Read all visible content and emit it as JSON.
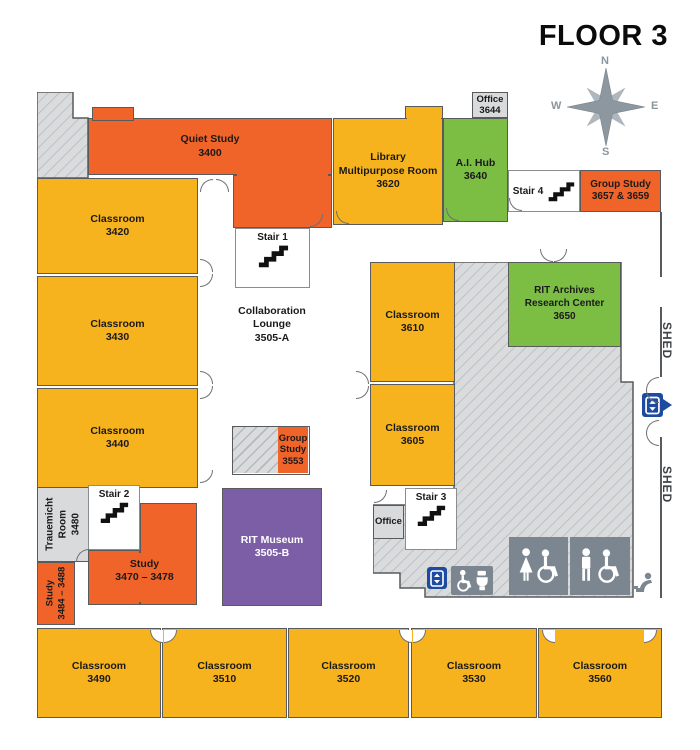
{
  "title": "FLOOR 3",
  "compass": {
    "north": "N",
    "south": "S",
    "east": "E",
    "west": "W"
  },
  "shed": {
    "upper": "SHED",
    "lower": "SHED"
  },
  "rooms": {
    "quiet_study": {
      "line1": "Quiet Study",
      "number": "3400"
    },
    "classroom_3420": {
      "line1": "Classroom",
      "number": "3420"
    },
    "classroom_3430": {
      "line1": "Classroom",
      "number": "3430"
    },
    "classroom_3440": {
      "line1": "Classroom",
      "number": "3440"
    },
    "library": {
      "line1": "Library",
      "line2": "Multipurpose Room",
      "number": "3620"
    },
    "ai_hub": {
      "line1": "A.I. Hub",
      "number": "3640"
    },
    "office_3644": {
      "line1": "Office",
      "number": "3644"
    },
    "group_study_3657": {
      "line1": "Group Study",
      "number": "3657 & 3659"
    },
    "collaboration_lounge": {
      "line1": "Collaboration",
      "line2": "Lounge",
      "number": "3505-A"
    },
    "group_study_3553": {
      "line1": "Group",
      "line2": "Study",
      "number": "3553"
    },
    "rit_museum": {
      "line1": "RIT Museum",
      "number": "3505-B"
    },
    "classroom_3610": {
      "line1": "Classroom",
      "number": "3610"
    },
    "classroom_3605": {
      "line1": "Classroom",
      "number": "3605"
    },
    "rit_archives": {
      "line1": "RIT Archives",
      "line2": "Research Center",
      "number": "3650"
    },
    "trauemicht": {
      "line1": "Trauemicht",
      "line2": "Room",
      "number": "3480"
    },
    "study_3470": {
      "line1": "Study",
      "number": "3470 – 3478"
    },
    "study_3484": {
      "line1": "Study",
      "number": "3484 – 3488"
    },
    "office_small": {
      "line1": "Office"
    },
    "classroom_3490": {
      "line1": "Classroom",
      "number": "3490"
    },
    "classroom_3510": {
      "line1": "Classroom",
      "number": "3510"
    },
    "classroom_3520": {
      "line1": "Classroom",
      "number": "3520"
    },
    "classroom_3530": {
      "line1": "Classroom",
      "number": "3530"
    },
    "classroom_3560": {
      "line1": "Classroom",
      "number": "3560"
    }
  },
  "stairs": {
    "stair1": "Stair 1",
    "stair2": "Stair 2",
    "stair3": "Stair 3",
    "stair4": "Stair 4"
  },
  "icons": {
    "compass": "compass-rose",
    "stairs": "stairs",
    "elevator": "elevator",
    "elevator_exit": "elevator-exit",
    "accessible_restroom": "accessible-restroom",
    "womens_restroom": "womens-accessible-restroom",
    "mens_restroom": "mens-accessible-restroom",
    "drinking_fountain": "drinking-fountain"
  },
  "colors": {
    "classroom_yellow": "#F7B31E",
    "study_orange": "#F0642A",
    "special_green": "#7CBE44",
    "museum_purple": "#7C5EA6",
    "service_gray": "#D8DADB",
    "restroom_gray": "#7B8690",
    "elevator_blue": "#1E4B9F"
  }
}
